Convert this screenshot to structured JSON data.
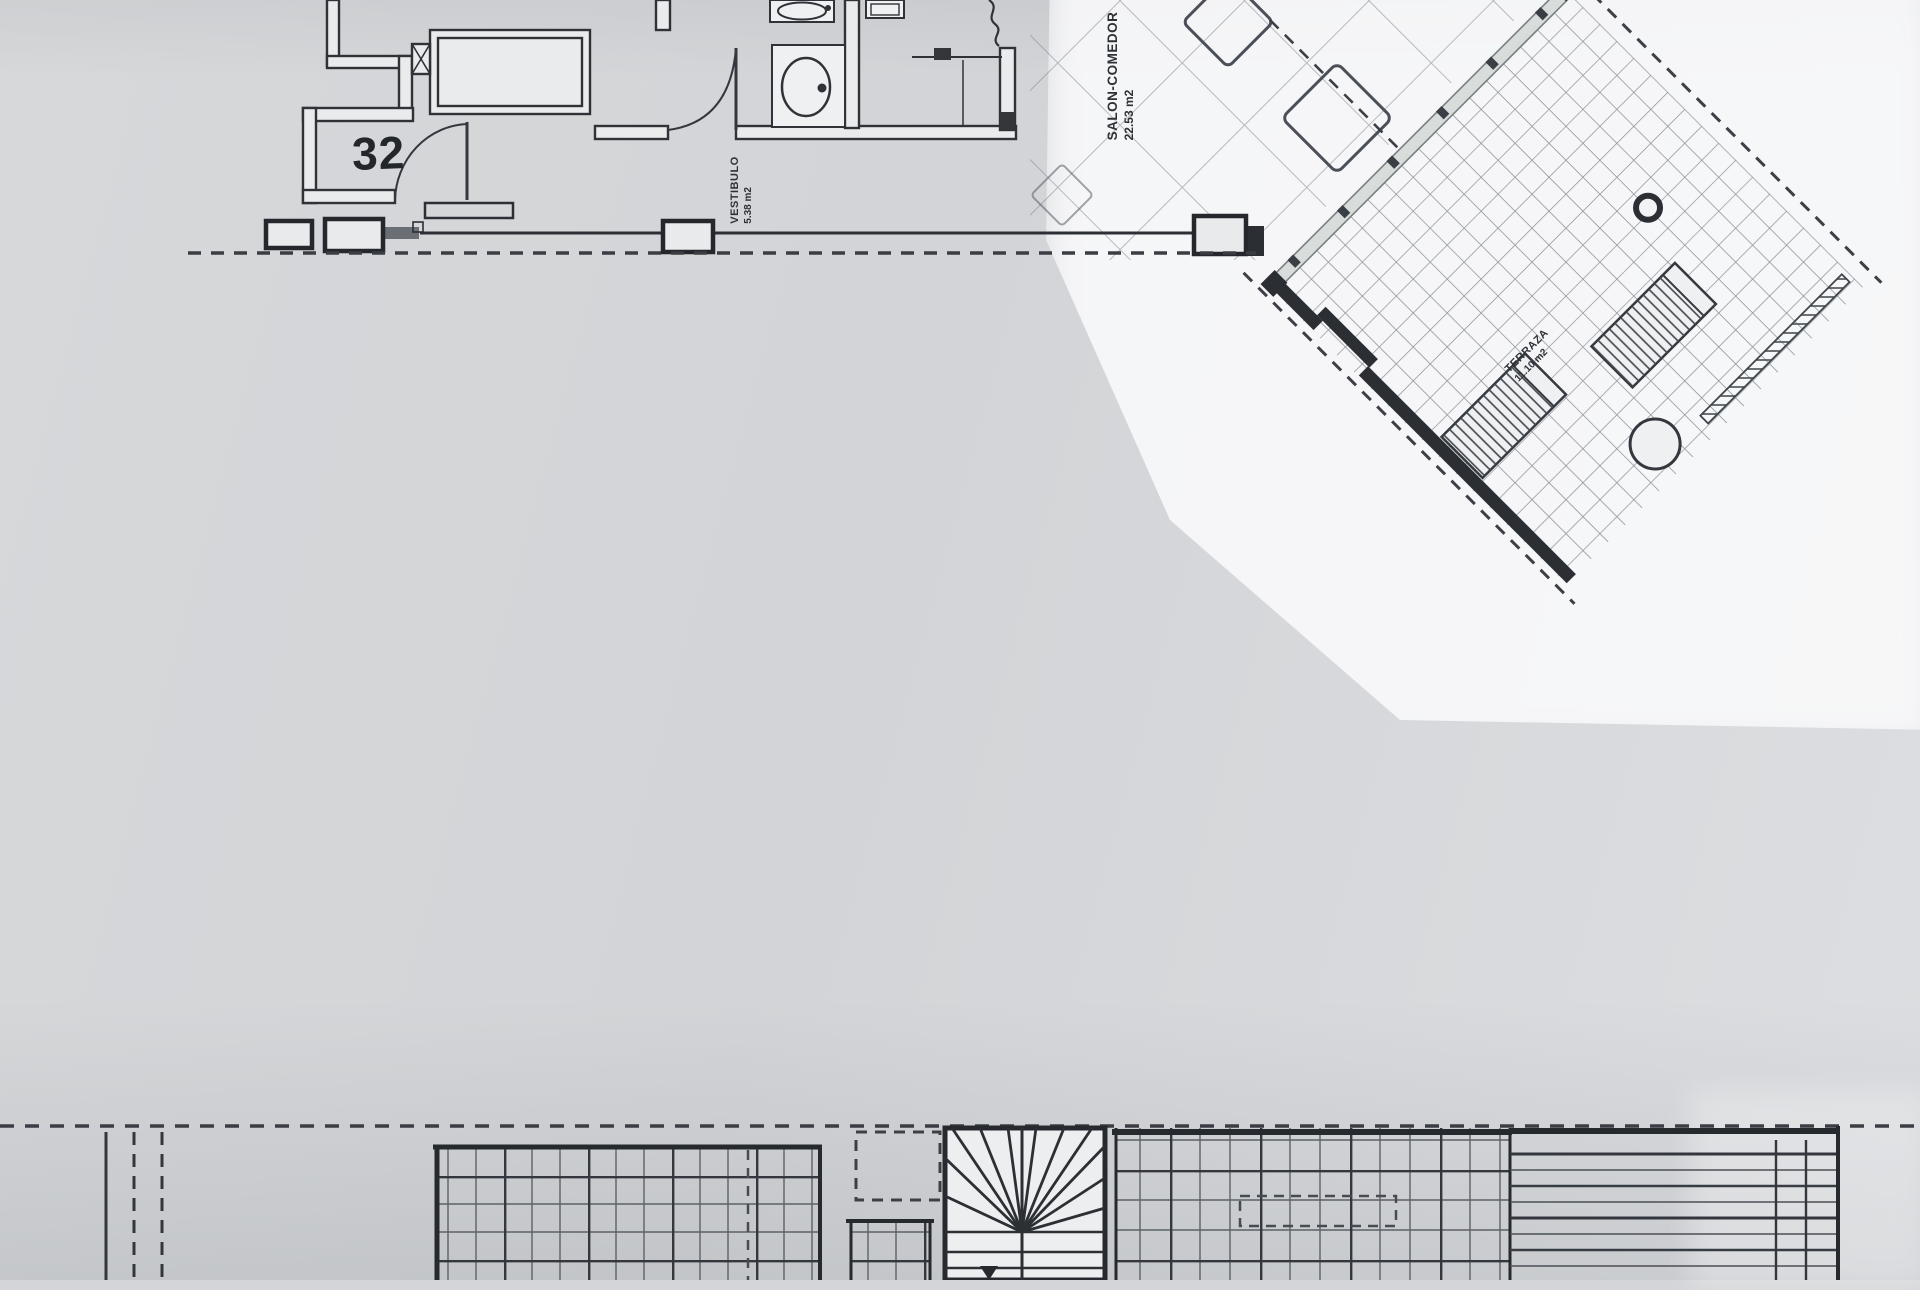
{
  "sheet": {
    "unit_number": "32",
    "rooms": {
      "vestibulo": {
        "name": "VESTIBULO",
        "area": "5.38 m2"
      },
      "salon": {
        "name": "SALON-COMEDOR",
        "area": "22.53 m2"
      },
      "terraza": {
        "name": "TERRAZA",
        "area": "11.10 m2"
      }
    },
    "colors": {
      "paper": "#d3d5d8",
      "paper_bright": "#f1f2f4",
      "ink": "#2b2e33"
    }
  }
}
